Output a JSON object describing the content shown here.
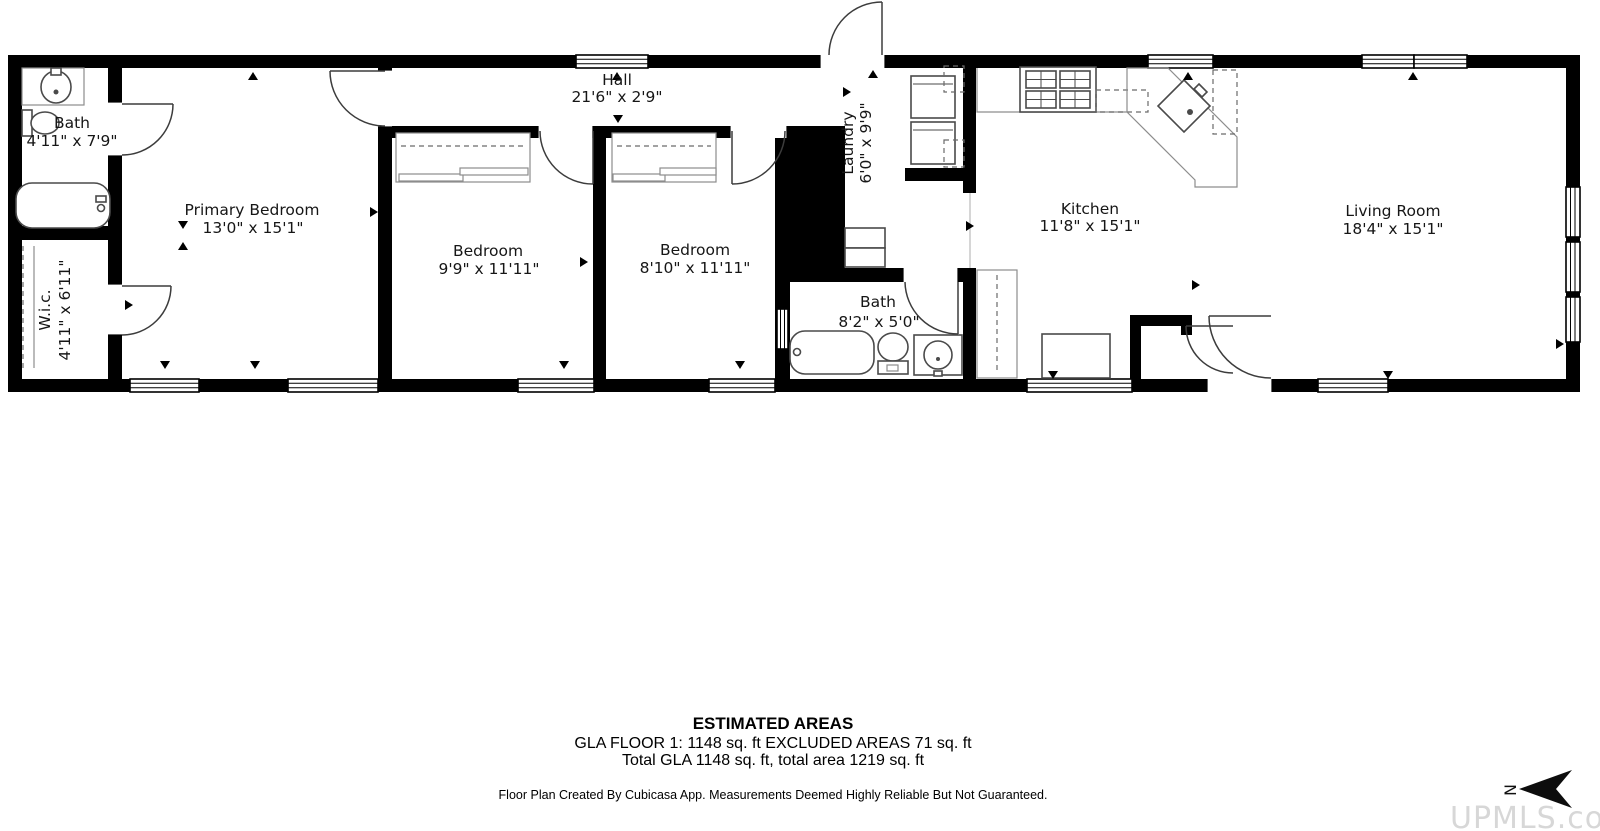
{
  "floor_plan": {
    "rooms": [
      {
        "name": "Bath",
        "dims": "4'11\" x 7'9\""
      },
      {
        "name": "W.i.c.",
        "dims": "4'11\" x 6'11\""
      },
      {
        "name": "Primary Bedroom",
        "dims": "13'0\" x 15'1\""
      },
      {
        "name": "Hall",
        "dims": "21'6\" x 2'9\""
      },
      {
        "name": "Bedroom",
        "dims": "9'9\" x 11'11\""
      },
      {
        "name": "Bedroom",
        "dims": "8'10\" x 11'11\""
      },
      {
        "name": "Laundry",
        "dims": "6'0\" x 9'9\""
      },
      {
        "name": "Bath",
        "dims": "8'2\" x 5'0\""
      },
      {
        "name": "Kitchen",
        "dims": "11'8\" x 15'1\""
      },
      {
        "name": "Living Room",
        "dims": "18'4\" x 15'1\""
      }
    ],
    "compass": {
      "label": "N"
    }
  },
  "areas": {
    "title": "ESTIMATED AREAS",
    "line1": "GLA FLOOR 1: 1148 sq. ft EXCLUDED AREAS 71 sq. ft",
    "line2": "Total GLA 1148 sq. ft, total area 1219 sq. ft",
    "disclaimer": "Floor Plan Created By Cubicasa App. Measurements Deemed Highly Reliable But Not Guaranteed."
  },
  "watermark": {
    "text": "UPMLS.com"
  },
  "colors": {
    "wall": "#000000",
    "label_text": "#161616",
    "watermark": "#d7d7d7"
  }
}
